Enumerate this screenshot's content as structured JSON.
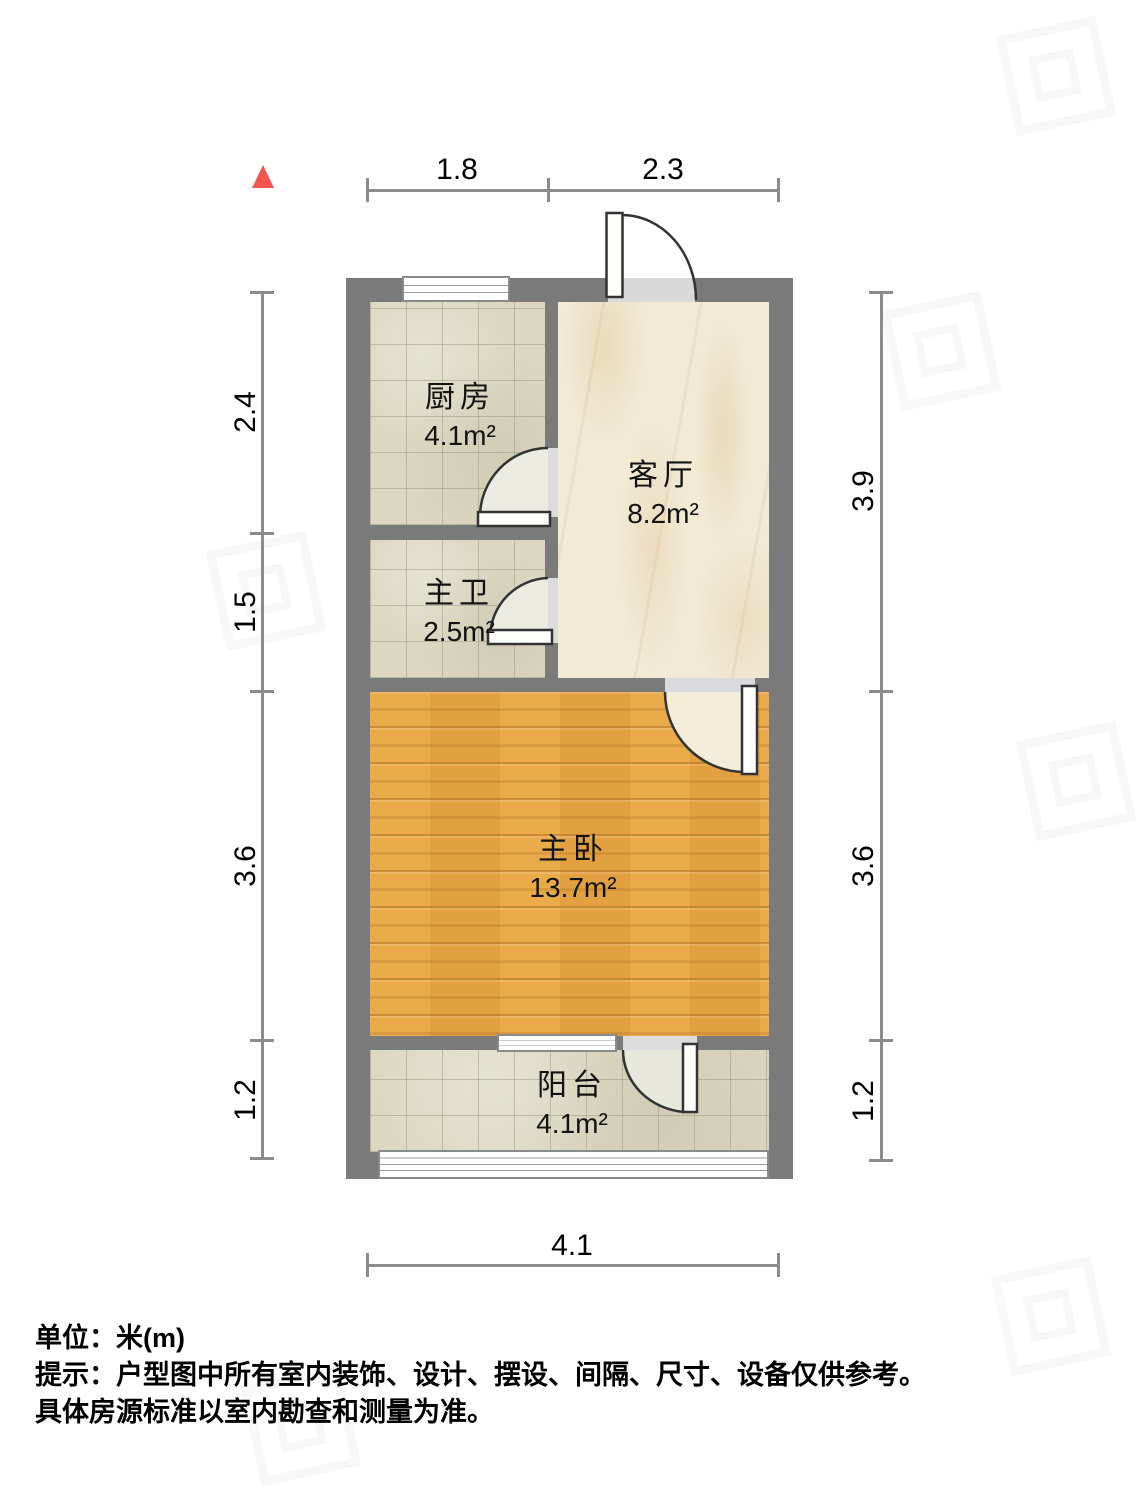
{
  "north": {
    "icon": "north-triangle",
    "color": "#f4544e"
  },
  "rooms": [
    {
      "name": "厨房",
      "area": "4.1m²"
    },
    {
      "name": "主卫",
      "area": "2.5m²"
    },
    {
      "name": "客厅",
      "area": "8.2m²"
    },
    {
      "name": "主卧",
      "area": "13.7m²"
    },
    {
      "name": "阳台",
      "area": "4.1m²"
    }
  ],
  "dimensions": {
    "top": [
      "1.8",
      "2.3"
    ],
    "bottom": [
      "4.1"
    ],
    "left": [
      "2.4",
      "1.5",
      "3.6",
      "1.2"
    ],
    "right": [
      "3.9",
      "3.6",
      "1.2"
    ]
  },
  "notes": {
    "unit": "单位：米(m)",
    "line1": "提示：户型图中所有室内装饰、设计、摆设、间隔、尺寸、设备仅供参考。",
    "line2": "具体房源标准以室内勘查和测量为准。"
  },
  "colors": {
    "wall": "#7a7a7a",
    "tile": "#dbd7c0",
    "marble": "#f2ead5",
    "wood": "#e7a544"
  }
}
